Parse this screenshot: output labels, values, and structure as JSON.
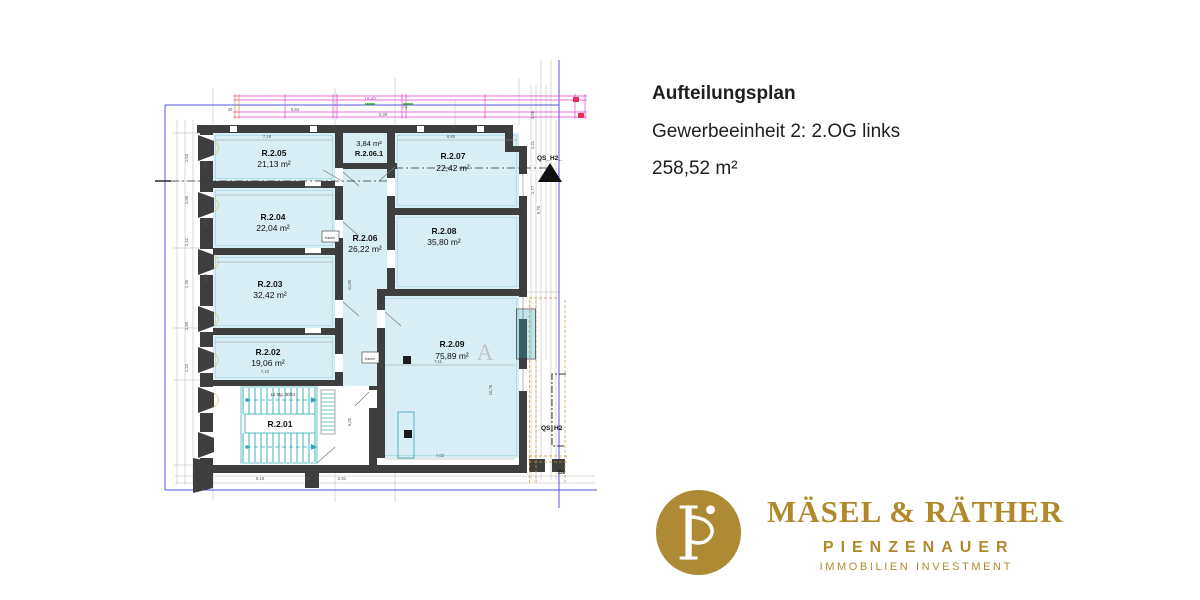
{
  "header": {
    "title": "Aufteilungsplan",
    "subtitle": "Gewerbeeinheit 2: 2.OG links",
    "total_area": "258,52 m²"
  },
  "brand": {
    "name": "MÄSEL & RÄTHER",
    "division": "PIENZENAUER",
    "tagline": "IMMOBILIEN INVESTMENT",
    "gold": "#b1892b"
  },
  "plan": {
    "rooms": [
      {
        "id": "R.2.05",
        "area": "21,13 m²"
      },
      {
        "id": "R.2.04",
        "area": "22,04 m²"
      },
      {
        "id": "R.2.03",
        "area": "32,42 m²"
      },
      {
        "id": "R.2.02",
        "area": "19,06 m²"
      },
      {
        "id": "R.2.01",
        "area": ""
      },
      {
        "id": "R.2.06",
        "area": "26,22 m²"
      },
      {
        "id": "R.2.06.1",
        "area": "3,84 m²"
      },
      {
        "id": "R.2.07",
        "area": "22,42 m²"
      },
      {
        "id": "R.2.08",
        "area": "35,80 m²"
      },
      {
        "id": "R.2.09",
        "area": "75,89 m²"
      }
    ],
    "annotations": {
      "section_top": "QS_H2_",
      "section_right": "QS_H2",
      "watermark": "A",
      "kamin": "Kamin",
      "stair_note": "16 Stg. 30/14",
      "ds": "Ds"
    },
    "dims": [
      "7,18",
      "6,80",
      "20",
      "6,84",
      "18,40",
      "2,39",
      "7,10",
      "7,11",
      "10,76",
      "5,00",
      "6,18",
      "40",
      "2,81",
      "7,02",
      "1,53",
      "1,86",
      "1,41",
      "1,36",
      "1,80",
      "1,22",
      "2,87",
      "2,50",
      "2,23",
      "11,80",
      "1,66",
      "1,21",
      "1,77",
      "6,70",
      "73"
    ],
    "colors": {
      "wall": "#3e3e3e",
      "room_fill": "#d9edf4",
      "boundary_blue": "#5353e8",
      "dim_magenta": "#e044cc",
      "stair_teal": "#2aa7b8",
      "survey_orange": "#cc9933"
    }
  }
}
